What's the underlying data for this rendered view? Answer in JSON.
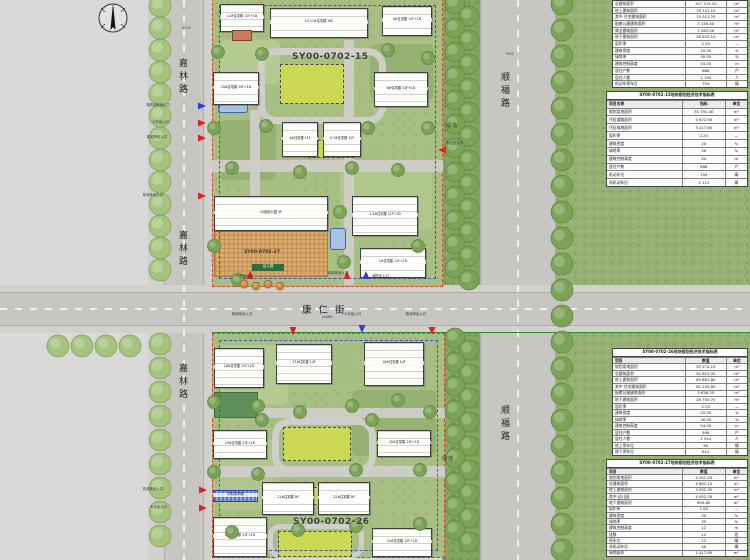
{
  "compass": {
    "name": "north-arrow"
  },
  "roads": {
    "jialin_top": "嘉林路",
    "jialin_mid": "嘉林路",
    "jialin_bottom": "嘉林路",
    "shunfu_top": "顺福路",
    "shunfu_bottom": "顺福路",
    "kangren": "康仁街",
    "kangren_sub": "(40M)"
  },
  "plots": {
    "top_label": "SY00-0702-15",
    "bottom_label": "SY00-0702-26",
    "kindergarten_label": "SY00-0702-27"
  },
  "green_labels": {
    "top": "绿地",
    "bottom": "绿地"
  },
  "dimensions": {
    "top_left": "5143",
    "top_right": "7603"
  },
  "kindergarten_tag": "幼儿园",
  "palette": {
    "boundary_red": "#e03c30",
    "setback_blue": "#3a57c0",
    "green_line": "#2e8b2e",
    "entrance_red": "#e0231f",
    "entrance_blue": "#2b3fd0",
    "lawn": "#ccd955",
    "plaza_orange": "#d9a96d",
    "water_blue": "#a9c3e2"
  },
  "buildings": [
    {
      "label": "12#住宅楼 11F+1D"
    },
    {
      "label": "10-11#住宅楼 16F"
    },
    {
      "label": "9#住宅楼 11F+1D"
    },
    {
      "label": ""
    },
    {
      "label": "15#住宅楼 15F+1D"
    },
    {
      "label": "8#住宅楼 11F+1D"
    },
    {
      "label": "4#住宅楼 11F"
    },
    {
      "label": "5-7#住宅楼 11F"
    },
    {
      "label": "12班幼儿园 3F"
    },
    {
      "label": "2-3#住宅楼 11F+1D"
    },
    {
      "label": "1#住宅楼 11F+1D"
    },
    {
      "label": "16#住宅楼 11F+1D"
    },
    {
      "label": "17#住宅楼 14F"
    },
    {
      "label": "18#住宅楼 14F"
    },
    {
      "label": "19#住宅楼 11F+1D"
    },
    {
      "label": "20#住宅楼 11F+1D"
    },
    {
      "label": "21#住宅楼 9F"
    },
    {
      "label": "22#住宅楼 9F"
    },
    {
      "label": "23#住宅楼 11F+1D"
    },
    {
      "label": "24#住宅楼 11F+1D"
    },
    {
      "label": "非机动车棚"
    }
  ],
  "entrances": [
    {
      "label": "非机动车出入口",
      "color": "blue"
    },
    {
      "label": "人行出入口",
      "color": "red"
    },
    {
      "label": "机动车出入口",
      "color": "red"
    },
    {
      "label": "机动车出入口",
      "color": "red"
    },
    {
      "label": "人行出入口",
      "color": "red"
    },
    {
      "label": "机动车出入口",
      "color": "red"
    },
    {
      "label": "消防出入口",
      "color": "blue"
    },
    {
      "label": "人行出入口",
      "color": "red"
    },
    {
      "label": "机动车出入口",
      "color": "red"
    },
    {
      "label": "人行出入口",
      "color": "blue"
    },
    {
      "label": "机动车出入口",
      "color": "red"
    },
    {
      "label": "机动车出入口",
      "color": "red"
    },
    {
      "label": "人行出入口",
      "color": "red"
    }
  ],
  "tables": [
    {
      "title": "",
      "headers": null,
      "rows": [
        [
          "总建筑面积",
          "107 374.20",
          "m²"
        ],
        [
          "地上建筑面积",
          "78 741.10",
          "m²"
        ],
        [
          "其中 住宅建筑面积",
          "74 012.70",
          "m²"
        ],
        [
          "配套公建建筑面积",
          "3 145.40",
          "m²"
        ],
        [
          "商业建筑面积",
          "1 583.00",
          "m²"
        ],
        [
          "地下建筑面积",
          "28 633.10",
          "m²"
        ],
        [
          "容积率",
          "2.20",
          "—"
        ],
        [
          "建筑密度",
          "20.00",
          "%"
        ],
        [
          "绿地率",
          "30.00",
          "%"
        ],
        [
          "建筑控制高度",
          "54.00",
          "m"
        ],
        [
          "居住户数",
          "686",
          "户"
        ],
        [
          "居住人数",
          "2 195",
          "人"
        ],
        [
          "机动车停车位",
          "704",
          "辆"
        ]
      ]
    },
    {
      "title": "SY00-0702-15地块规划经济技术指标表",
      "headers": [
        "项目名称",
        "指标",
        "单位"
      ],
      "rows": [
        [
          "规划用地面积",
          "35 791.40",
          "m²"
        ],
        [
          "代征道路面积",
          "4 672.90",
          "m²"
        ],
        [
          "代征绿地面积",
          "3 217.60",
          "m²"
        ],
        [
          "容积率",
          "2.20",
          "—"
        ],
        [
          "建筑密度",
          "20",
          "%"
        ],
        [
          "绿地率",
          "30",
          "%"
        ],
        [
          "建筑控制高度",
          "54",
          "m"
        ],
        [
          "居住户数",
          "686",
          "户"
        ],
        [
          "机动车位",
          "704",
          "辆"
        ],
        [
          "非机动车位",
          "2 112",
          "辆"
        ]
      ]
    },
    {
      "title": "SY00-0702-26地块规划经济技术指标表",
      "headers": [
        "项目",
        "数值",
        "单位"
      ],
      "rows": [
        [
          "规划用地面积",
          "29 274.10",
          "m²"
        ],
        [
          "总建筑面积",
          "92 612.50",
          "m²"
        ],
        [
          "地上建筑面积",
          "65 861.80",
          "m²"
        ],
        [
          "其中 住宅建筑面积",
          "62 235.60",
          "m²"
        ],
        [
          "配套公建建筑面积",
          "3 626.20",
          "m²"
        ],
        [
          "地下建筑面积",
          "26 750.70",
          "m²"
        ],
        [
          "容积率",
          "2.25",
          "—"
        ],
        [
          "建筑密度",
          "22.00",
          "%"
        ],
        [
          "绿地率",
          "30.00",
          "%"
        ],
        [
          "建筑控制高度",
          "54.00",
          "m"
        ],
        [
          "居住户数",
          "598",
          "户"
        ],
        [
          "居住人数",
          "1 914",
          "人"
        ],
        [
          "地上停车位",
          "60",
          "辆"
        ],
        [
          "地下停车位",
          "610",
          "辆"
        ]
      ]
    },
    {
      "title": "SY00-0702-27地块规划经济技术指标表",
      "headers": [
        "项目",
        "数值",
        "单位"
      ],
      "rows": [
        [
          "规划用地面积",
          "4 051.20",
          "m²"
        ],
        [
          "总建筑面积",
          "4 862.10",
          "m²"
        ],
        [
          "地上建筑面积",
          "4 052.30",
          "m²"
        ],
        [
          "其中 幼儿园",
          "4 052.30",
          "m²"
        ],
        [
          "地下建筑面积",
          "809.80",
          "m²"
        ],
        [
          "容积率",
          "1.00",
          "—"
        ],
        [
          "建筑密度",
          "30",
          "%"
        ],
        [
          "绿地率",
          "35",
          "%"
        ],
        [
          "建筑控制高度",
          "12",
          "m"
        ],
        [
          "班数",
          "12",
          "班"
        ],
        [
          "停车位",
          "12",
          "辆"
        ],
        [
          "非机动车位",
          "40",
          "辆"
        ],
        [
          "绿地面积",
          "1 417.90",
          "m²"
        ]
      ]
    }
  ]
}
